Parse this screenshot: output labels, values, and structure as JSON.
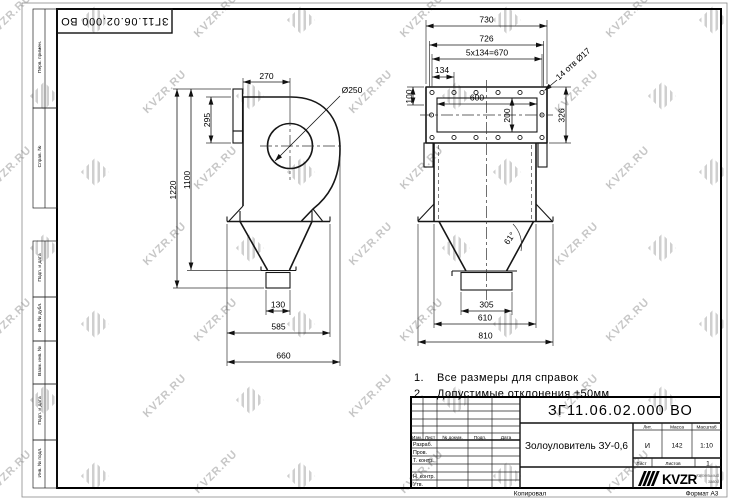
{
  "watermark": {
    "text": "KVZR.RU"
  },
  "corner_stamp": {
    "doc_number": "ЗГ11.06.02.000 ВО"
  },
  "margin_labels": [
    "Перв. примен.",
    "Справ. №",
    "Подп. и дата",
    "Инв. № дубл.",
    "Взам. инв. №",
    "Подп. и дата",
    "Инв. № подл."
  ],
  "notes": {
    "n1_num": "1.",
    "n1_text": "Все размеры для справок",
    "n2_num": "2.",
    "n2_text": "Допустимые отклонения ±50мм"
  },
  "views": {
    "left": {
      "d270": "270",
      "dia250": "Ø250",
      "d295": "295",
      "d1220": "1220",
      "d1100": "1100",
      "d130": "130",
      "d585": "585",
      "d660": "660"
    },
    "right": {
      "d730": "730",
      "d726": "726",
      "d670": "5x134=670",
      "d134": "134",
      "holes": "14 отв Ø17",
      "d100": "100",
      "d600": "600",
      "d200": "200",
      "d326": "326",
      "angle": "61°",
      "d305": "305",
      "d610": "610",
      "d810": "810"
    }
  },
  "title_block": {
    "doc_number": "ЗГ11.06.02.000 ВО",
    "name": "Золоуловитель ЗУ-0,6",
    "header_cols": [
      "Изм.",
      "Лист",
      "№ докум.",
      "Подп.",
      "Дата"
    ],
    "row_labels": [
      "Разраб.",
      "Пров.",
      "Т. контр.",
      "",
      "Н. контр.",
      "Утв."
    ],
    "lit_label": "Лит.",
    "lit_value": "И",
    "mass_label": "Масса",
    "mass_value": "142",
    "scale_label": "Масштаб",
    "scale_value": "1:10",
    "sheet_label": "Лист",
    "sheets_label": "Листов",
    "sheets_value": "1",
    "logo_text": "KVZR",
    "logo_sub_1": "Котельный",
    "logo_sub_2": "завод"
  },
  "footer": {
    "copied": "Копировал",
    "format": "Формат А3"
  }
}
